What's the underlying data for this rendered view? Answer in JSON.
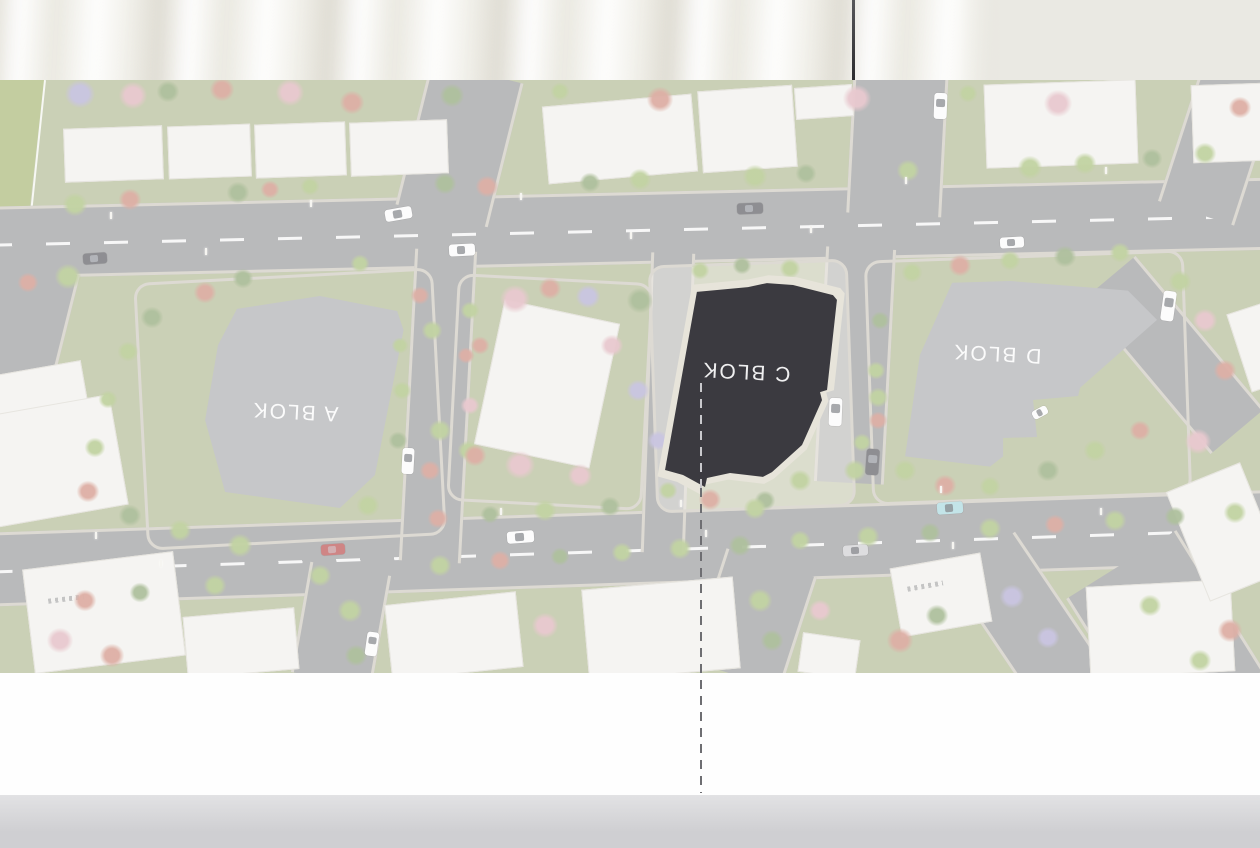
{
  "scene": {
    "backdrop": {
      "curtain_base": "#f2f1eb",
      "wall_right": "#eae9e3",
      "rod_color_top": "#57575a",
      "rod_color_bottom": "#2c2c2f"
    },
    "board": {
      "margin_color": "#fefefe",
      "floor_top": "#e2e2e4",
      "floor_bottom": "#cfcfd2"
    }
  },
  "map": {
    "top": 80,
    "height": 593,
    "wash": "rgba(255,255,255,0.38)",
    "colors": {
      "lawn": "#aab389",
      "road": "#8f9092",
      "road_edge": "#c8c3b8",
      "building_white": "#efeeea",
      "building_edge": "#d8d5cd",
      "roof_gray": "#a3a5a9",
      "roof_dark": "#3b3a40",
      "plinth": "#e7e4da",
      "wedge_green": "#9fae66",
      "label_white": "rgba(255,255,255,0.92)",
      "guide_dark": "#6e6e72",
      "guide_light": "#c9c9cd",
      "island_plaza": "rgba(232,229,221,0.45)",
      "trees": {
        "g": "#9db86a",
        "e": "#7e9a62",
        "p": "#dba8b2",
        "r": "#c97f6f",
        "d": "#b06a5e",
        "v": "#a9a2cf"
      },
      "cars": {
        "white": "#fafafa",
        "dark": "#4a4a4f",
        "red": "#b23b3b",
        "cyan": "#9fd4da",
        "silver": "#c9c9cc"
      }
    },
    "labels": [
      {
        "id": "block-a",
        "text": "A BLOK",
        "x": 295,
        "y": 411,
        "size": 21,
        "rot": 183
      },
      {
        "id": "block-c",
        "text": "C BLOK",
        "x": 746,
        "y": 371,
        "size": 21,
        "rot": 183
      },
      {
        "id": "block-d",
        "text": "D BLOK",
        "x": 997,
        "y": 353,
        "size": 21,
        "rot": 183
      }
    ],
    "wedge": {
      "x": 0,
      "y": 80,
      "w": 48,
      "h": 352,
      "clip": "polygon(0% 0%, 92% 0%, 33% 71%, 0% 100%)",
      "line": {
        "x": 44,
        "y": 80,
        "len": 354,
        "rot": 6
      }
    },
    "roads": [
      [
        -20,
        192,
        1320,
        72,
        -1.3,
        "h",
        true
      ],
      [
        -20,
        511,
        1320,
        74,
        -1.9,
        "h",
        true
      ],
      [
        412,
        70,
        95,
        148,
        14,
        "v",
        false
      ],
      [
        850,
        70,
        95,
        145,
        3,
        "v",
        false
      ],
      [
        820,
        248,
        70,
        235,
        3,
        "v",
        false
      ],
      [
        1180,
        62,
        80,
        155,
        18,
        "v",
        false
      ],
      [
        1138,
        255,
        70,
        200,
        -40,
        "v",
        false
      ],
      [
        706,
        560,
        95,
        118,
        18,
        "v",
        false
      ],
      [
        300,
        568,
        82,
        112,
        10,
        "v",
        false
      ],
      [
        988,
        540,
        80,
        165,
        -34,
        "v",
        false
      ],
      [
        -30,
        262,
        95,
        135,
        14,
        "v",
        false
      ],
      [
        407,
        250,
        62,
        312,
        3,
        "v",
        false
      ],
      [
        646,
        253,
        44,
        300,
        2,
        "v",
        false
      ],
      [
        1100,
        552,
        130,
        165,
        -32,
        "v",
        false
      ]
    ],
    "islands": [
      [
        140,
        275,
        300,
        268,
        -3,
        false
      ],
      [
        452,
        278,
        196,
        228,
        3,
        false
      ],
      [
        652,
        262,
        200,
        248,
        -2,
        true
      ],
      [
        868,
        255,
        320,
        245,
        -2,
        false
      ]
    ],
    "buildings": [
      [
        64,
        127,
        99,
        54,
        -2,
        "white"
      ],
      [
        168,
        125,
        83,
        53,
        -2,
        "white"
      ],
      [
        255,
        123,
        91,
        54,
        -2,
        "white"
      ],
      [
        350,
        121,
        98,
        54,
        -2,
        "white"
      ],
      [
        -10,
        368,
        95,
        42,
        -10,
        "white"
      ],
      [
        -15,
        405,
        135,
        112,
        -10,
        "white"
      ],
      [
        545,
        100,
        150,
        78,
        -5,
        "ridged"
      ],
      [
        700,
        88,
        95,
        82,
        -4,
        "ridged"
      ],
      [
        795,
        86,
        58,
        32,
        -4,
        "white"
      ],
      [
        985,
        82,
        152,
        84,
        -2,
        "ridged"
      ],
      [
        1192,
        84,
        72,
        78,
        -2,
        "white"
      ],
      [
        488,
        310,
        118,
        148,
        12,
        "white"
      ],
      [
        28,
        560,
        152,
        105,
        -7,
        "marked"
      ],
      [
        185,
        612,
        112,
        62,
        -5,
        "white"
      ],
      [
        388,
        598,
        132,
        76,
        -6,
        "white"
      ],
      [
        585,
        583,
        152,
        92,
        -5,
        "white"
      ],
      [
        800,
        636,
        58,
        40,
        8,
        "white"
      ],
      [
        895,
        560,
        92,
        70,
        -10,
        "marked"
      ],
      [
        1088,
        583,
        145,
        92,
        -3,
        "white"
      ],
      [
        1185,
        473,
        80,
        118,
        -22,
        "white"
      ],
      [
        1238,
        306,
        42,
        82,
        -18,
        "white"
      ]
    ],
    "blocks": [
      {
        "id": "block-a",
        "x": 195,
        "y": 288,
        "w": 215,
        "h": 235,
        "poly": "polygon(19.5% 8.9%, 58.1% 3.4%, 94% 9.8%, 97% 17.9%, 83.7% 79.6%, 67.4% 93.6%, 14% 86.8%, 4.7% 56.2%, 10.7% 24.3%)"
      },
      {
        "id": "block-d",
        "x": 880,
        "y": 275,
        "w": 285,
        "h": 205,
        "poly": "polygon(25.3% 3.8%, 45.6% 2.9%, 87% 7.6%, 97.2% 21.9%, 70.2% 55%, 69.5% 59%, 53.7% 61%, 55.1% 79%, 43.2% 79.5%, 43.2% 88.5%, 38.6% 93.5%, 8.8% 88.5%, 14% 39%)"
      }
    ],
    "highlight": {
      "id": "block-c",
      "x": 660,
      "y": 281,
      "w": 180,
      "h": 210,
      "pad": 8,
      "poly": "polygon(20.5% 5.2%, 48.9% 2.9%, 59.4% 1%, 73.9% 1.9%, 96.1% 6.7%, 98.3% 9%, 92.8% 51.9%, 88.9% 52.9%, 90% 56.7%, 78.9% 78.1%, 62.2% 91%, 57.2% 93.3%, 38.9% 91.4%, 26.1% 93.8%, 25% 98.1%, 12.8% 92.4%, 2.8% 90%)"
    },
    "trees": [
      [
        80,
        95,
        16,
        "v"
      ],
      [
        133,
        96,
        15,
        "p"
      ],
      [
        168,
        92,
        12,
        "e"
      ],
      [
        222,
        90,
        13,
        "r"
      ],
      [
        290,
        93,
        15,
        "p"
      ],
      [
        352,
        103,
        13,
        "r"
      ],
      [
        452,
        96,
        13,
        "e"
      ],
      [
        560,
        92,
        10,
        "g"
      ],
      [
        660,
        100,
        14,
        "r"
      ],
      [
        857,
        99,
        15,
        "p"
      ],
      [
        968,
        94,
        10,
        "g"
      ],
      [
        1058,
        104,
        15,
        "p"
      ],
      [
        1240,
        108,
        12,
        "r"
      ],
      [
        75,
        205,
        13,
        "g"
      ],
      [
        130,
        200,
        12,
        "r"
      ],
      [
        238,
        193,
        12,
        "e"
      ],
      [
        270,
        190,
        10,
        "r"
      ],
      [
        310,
        187,
        10,
        "g"
      ],
      [
        445,
        184,
        12,
        "e"
      ],
      [
        487,
        187,
        12,
        "r"
      ],
      [
        590,
        183,
        11,
        "e"
      ],
      [
        640,
        180,
        12,
        "g"
      ],
      [
        755,
        177,
        13,
        "g"
      ],
      [
        806,
        174,
        11,
        "e"
      ],
      [
        908,
        171,
        12,
        "g"
      ],
      [
        1030,
        168,
        13,
        "g"
      ],
      [
        1085,
        164,
        12,
        "g"
      ],
      [
        1152,
        159,
        11,
        "e"
      ],
      [
        1205,
        154,
        12,
        "g"
      ],
      [
        68,
        277,
        14,
        "g"
      ],
      [
        28,
        283,
        11,
        "r"
      ],
      [
        205,
        293,
        12,
        "r"
      ],
      [
        243,
        279,
        11,
        "e"
      ],
      [
        360,
        264,
        10,
        "g"
      ],
      [
        700,
        271,
        10,
        "g"
      ],
      [
        742,
        266,
        10,
        "e"
      ],
      [
        790,
        269,
        11,
        "g"
      ],
      [
        912,
        273,
        11,
        "g"
      ],
      [
        960,
        266,
        12,
        "r"
      ],
      [
        1010,
        261,
        11,
        "g"
      ],
      [
        1065,
        257,
        12,
        "e"
      ],
      [
        1120,
        253,
        11,
        "g"
      ],
      [
        1180,
        282,
        12,
        "g"
      ],
      [
        152,
        318,
        12,
        "e"
      ],
      [
        128,
        352,
        11,
        "g"
      ],
      [
        108,
        400,
        10,
        "g"
      ],
      [
        95,
        448,
        11,
        "g"
      ],
      [
        88,
        492,
        12,
        "r"
      ],
      [
        130,
        516,
        12,
        "e"
      ],
      [
        180,
        531,
        12,
        "g"
      ],
      [
        240,
        546,
        13,
        "g"
      ],
      [
        420,
        296,
        10,
        "r"
      ],
      [
        432,
        331,
        11,
        "g"
      ],
      [
        440,
        431,
        12,
        "g"
      ],
      [
        430,
        471,
        11,
        "r"
      ],
      [
        400,
        346,
        9,
        "g"
      ],
      [
        402,
        391,
        10,
        "g"
      ],
      [
        398,
        441,
        10,
        "e"
      ],
      [
        470,
        311,
        10,
        "g"
      ],
      [
        466,
        356,
        9,
        "r"
      ],
      [
        470,
        406,
        10,
        "p"
      ],
      [
        468,
        451,
        11,
        "g"
      ],
      [
        515,
        300,
        16,
        "p"
      ],
      [
        550,
        289,
        12,
        "r"
      ],
      [
        480,
        346,
        10,
        "r"
      ],
      [
        520,
        466,
        16,
        "p"
      ],
      [
        475,
        456,
        12,
        "r"
      ],
      [
        580,
        476,
        13,
        "p"
      ],
      [
        640,
        301,
        14,
        "e"
      ],
      [
        612,
        346,
        12,
        "p"
      ],
      [
        588,
        297,
        13,
        "v"
      ],
      [
        638,
        391,
        12,
        "v"
      ],
      [
        658,
        441,
        11,
        "v"
      ],
      [
        668,
        491,
        10,
        "g"
      ],
      [
        800,
        481,
        12,
        "g"
      ],
      [
        765,
        501,
        11,
        "e"
      ],
      [
        855,
        471,
        12,
        "g"
      ],
      [
        755,
        509,
        12,
        "g"
      ],
      [
        878,
        398,
        11,
        "g"
      ],
      [
        862,
        443,
        10,
        "g"
      ],
      [
        905,
        471,
        12,
        "g"
      ],
      [
        945,
        486,
        12,
        "r"
      ],
      [
        990,
        487,
        11,
        "g"
      ],
      [
        1048,
        471,
        12,
        "e"
      ],
      [
        1095,
        451,
        12,
        "g"
      ],
      [
        1140,
        431,
        11,
        "r"
      ],
      [
        880,
        321,
        10,
        "e"
      ],
      [
        876,
        371,
        10,
        "g"
      ],
      [
        878,
        421,
        10,
        "r"
      ],
      [
        1205,
        321,
        13,
        "p"
      ],
      [
        1225,
        371,
        12,
        "r"
      ],
      [
        1198,
        442,
        14,
        "p"
      ],
      [
        368,
        506,
        12,
        "g"
      ],
      [
        438,
        519,
        11,
        "r"
      ],
      [
        490,
        515,
        10,
        "e"
      ],
      [
        545,
        511,
        12,
        "g"
      ],
      [
        610,
        507,
        11,
        "e"
      ],
      [
        710,
        500,
        12,
        "r"
      ],
      [
        85,
        601,
        12,
        "r"
      ],
      [
        140,
        593,
        11,
        "e"
      ],
      [
        215,
        586,
        12,
        "g"
      ],
      [
        320,
        576,
        12,
        "g"
      ],
      [
        440,
        566,
        12,
        "g"
      ],
      [
        500,
        561,
        11,
        "r"
      ],
      [
        560,
        557,
        10,
        "e"
      ],
      [
        622,
        553,
        11,
        "g"
      ],
      [
        680,
        549,
        12,
        "g"
      ],
      [
        740,
        546,
        12,
        "e"
      ],
      [
        800,
        541,
        11,
        "g"
      ],
      [
        868,
        537,
        12,
        "g"
      ],
      [
        930,
        533,
        11,
        "e"
      ],
      [
        990,
        529,
        12,
        "g"
      ],
      [
        1055,
        525,
        11,
        "r"
      ],
      [
        1115,
        521,
        12,
        "g"
      ],
      [
        1175,
        517,
        11,
        "e"
      ],
      [
        1235,
        513,
        12,
        "g"
      ],
      [
        60,
        641,
        14,
        "p"
      ],
      [
        112,
        656,
        13,
        "r"
      ],
      [
        350,
        611,
        13,
        "g"
      ],
      [
        356,
        656,
        12,
        "e"
      ],
      [
        545,
        626,
        14,
        "p"
      ],
      [
        760,
        601,
        13,
        "g"
      ],
      [
        772,
        641,
        12,
        "e"
      ],
      [
        820,
        611,
        12,
        "p"
      ],
      [
        900,
        641,
        14,
        "r"
      ],
      [
        937,
        616,
        12,
        "e"
      ],
      [
        1012,
        597,
        13,
        "v"
      ],
      [
        1048,
        638,
        12,
        "v"
      ],
      [
        1150,
        606,
        12,
        "g"
      ],
      [
        1230,
        631,
        13,
        "r"
      ],
      [
        1200,
        661,
        12,
        "g"
      ]
    ],
    "cars": [
      [
        398,
        214,
        27,
        12,
        -10,
        "white"
      ],
      [
        462,
        250,
        26,
        12,
        -3,
        "white"
      ],
      [
        750,
        208,
        26,
        11,
        -2,
        "dark"
      ],
      [
        1012,
        242,
        24,
        11,
        -3,
        "white"
      ],
      [
        95,
        258,
        24,
        11,
        -4,
        "dark"
      ],
      [
        940,
        106,
        13,
        26,
        2,
        "white"
      ],
      [
        1168,
        306,
        13,
        30,
        8,
        "white"
      ],
      [
        408,
        461,
        12,
        26,
        3,
        "white"
      ],
      [
        835,
        412,
        13,
        28,
        2,
        "white"
      ],
      [
        872,
        462,
        13,
        26,
        4,
        "dark"
      ],
      [
        520,
        537,
        27,
        12,
        -4,
        "white"
      ],
      [
        333,
        549,
        24,
        11,
        -4,
        "red"
      ],
      [
        855,
        550,
        25,
        11,
        -3,
        "silver"
      ],
      [
        950,
        508,
        26,
        12,
        -4,
        "cyan"
      ],
      [
        372,
        644,
        12,
        24,
        8,
        "white"
      ],
      [
        1040,
        412,
        16,
        9,
        -28,
        "white"
      ]
    ],
    "lamps": [
      [
        110,
        212
      ],
      [
        310,
        200
      ],
      [
        520,
        193
      ],
      [
        905,
        177
      ],
      [
        1105,
        167
      ],
      [
        205,
        248
      ],
      [
        630,
        232
      ],
      [
        810,
        226
      ],
      [
        95,
        532
      ],
      [
        500,
        508
      ],
      [
        680,
        500
      ],
      [
        940,
        486
      ],
      [
        160,
        560
      ],
      [
        705,
        530
      ],
      [
        1100,
        508
      ],
      [
        952,
        542
      ]
    ],
    "guide": {
      "x": 700,
      "light_y1": 383,
      "light_y2": 488,
      "dark_y1": 488,
      "dark_y2": 793
    },
    "rod": {
      "x": 852,
      "y1": 0,
      "y2": 80
    }
  }
}
